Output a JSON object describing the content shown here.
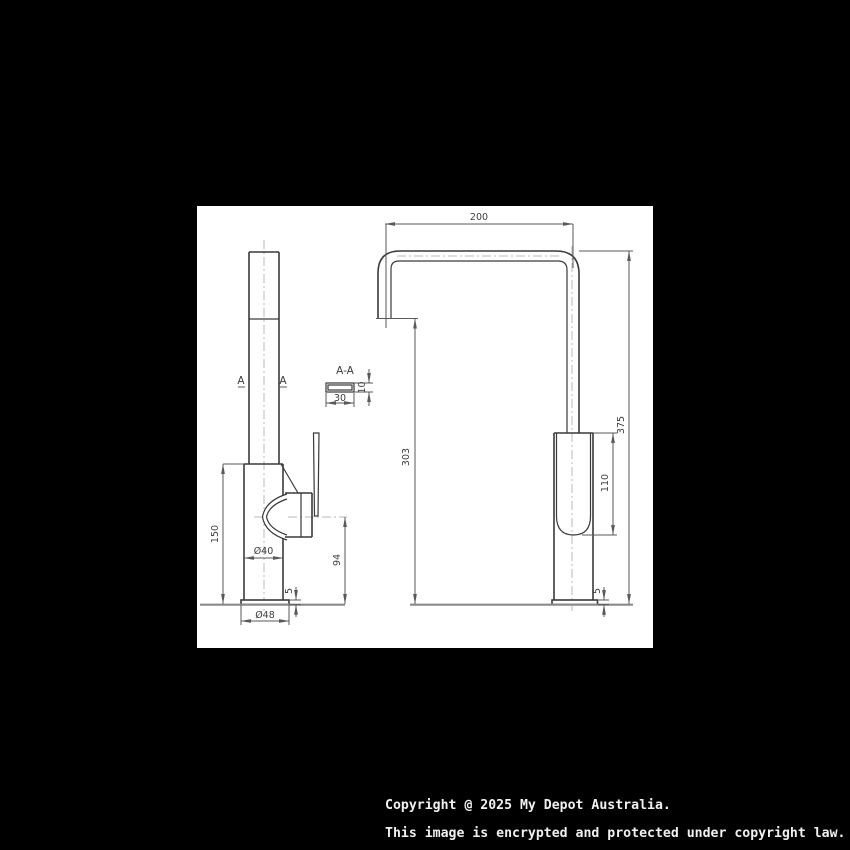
{
  "colors": {
    "page_bg": "#000000",
    "canvas_bg": "#ffffff",
    "outline": "#3a3a3a",
    "dimension_lines": "#5a5a5a",
    "centerline": "#b9b9b9",
    "ground_line": "#8a8a8a",
    "footer_text": "#f0f0f0"
  },
  "drawing": {
    "side_view": {
      "dim_150": "150",
      "dim_dia40": "Ø40",
      "dim_dia48": "Ø48",
      "dim_94": "94",
      "dim_5": "5",
      "marker_a_left": "A",
      "marker_a_right": "A"
    },
    "section_view": {
      "title": "A-A",
      "dim_30": "30",
      "dim_10": "10"
    },
    "front_view": {
      "dim_200": "200",
      "dim_375": "375",
      "dim_303": "303",
      "dim_110": "110",
      "dim_5": "5"
    }
  },
  "footer": {
    "line1": "Copyright @ 2025 My Depot Australia.",
    "line2": "This image is encrypted and protected under copyright law."
  }
}
